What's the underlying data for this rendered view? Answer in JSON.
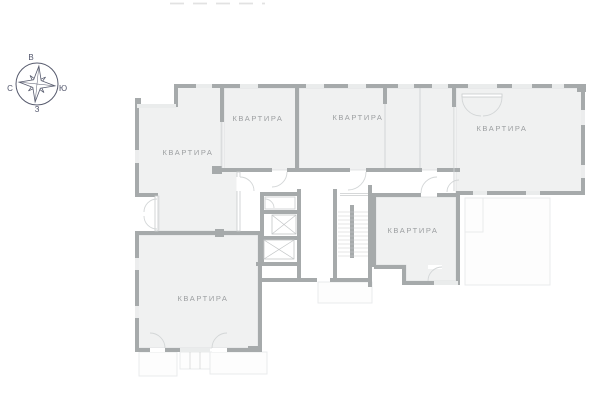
{
  "plan": {
    "apartments": [
      {
        "label": "КВАРТИРА"
      },
      {
        "label": "КВАРТИРА"
      },
      {
        "label": "КВАРТИРА"
      },
      {
        "label": "КВАРТИРА"
      },
      {
        "label": "КВАРТИРА"
      },
      {
        "label": "КВАРТИРА"
      }
    ]
  },
  "compass": {
    "top": "В",
    "right": "Ю",
    "bottom": "З",
    "left": "С"
  },
  "colors": {
    "wall": "#a6aaab",
    "room_fill": "#f0f1f1",
    "outline": "#dcdedf",
    "label": "#9b9ea0",
    "compass": "#50546a",
    "glazing": "#c9cccd",
    "faint": "#e7e9ea",
    "background": "#ffffff"
  }
}
